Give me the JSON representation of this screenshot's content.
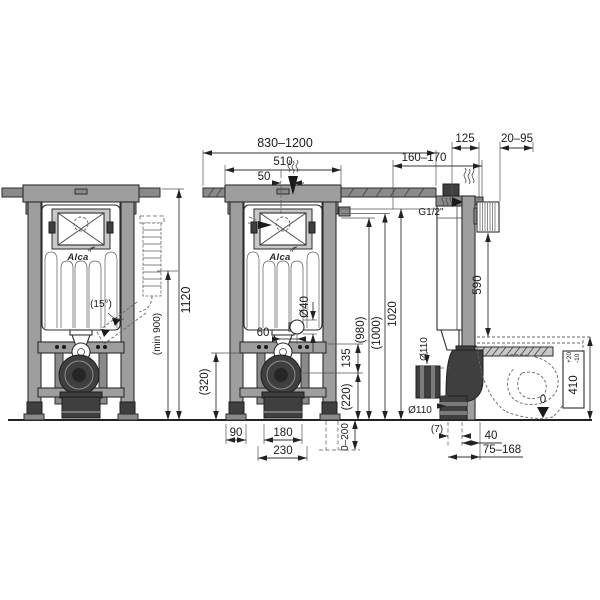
{
  "title": "Concealed WC installation frame - technical drawing",
  "brand": "Alca",
  "colors": {
    "background": "#ffffff",
    "line": "#2d2d2d",
    "frame_gray": "#9e9e9e",
    "part_dark": "#3f3f3f"
  },
  "views": {
    "front_example": {
      "labels": {
        "logo": "Alca",
        "height": "1120",
        "min_height": "(min 900)",
        "angle": "(15°)"
      }
    },
    "front_dimensioned": {
      "labels": {
        "mount_width": "830–1200",
        "frame_width": "510",
        "top_offset": "50",
        "outlet_offset": "60",
        "flush_pipe_d": "Ø40",
        "bracket_span": "135",
        "h220": "(220)",
        "h320": "(320)",
        "h980": "(980)",
        "h1000": "(1000)",
        "h1020": "1020",
        "foot_width": "90",
        "outlet_width": "180",
        "drain_width": "230",
        "leg_adjust": "0–200"
      }
    },
    "side": {
      "labels": {
        "depth_adjust": "160–170",
        "frame_depth": "125",
        "wall_offset": "20–95",
        "water_conn": "G1/2\"",
        "h590": "590",
        "waste_d_side": "Ø110",
        "waste_d_bottom": "Ø110",
        "bowl_height": "410",
        "bowl_tol_plus": "+20",
        "bowl_tol_minus": "-10",
        "floor_zero": "0",
        "off7": "(7)",
        "off40": "40",
        "outlet_range": "75–168"
      }
    }
  }
}
